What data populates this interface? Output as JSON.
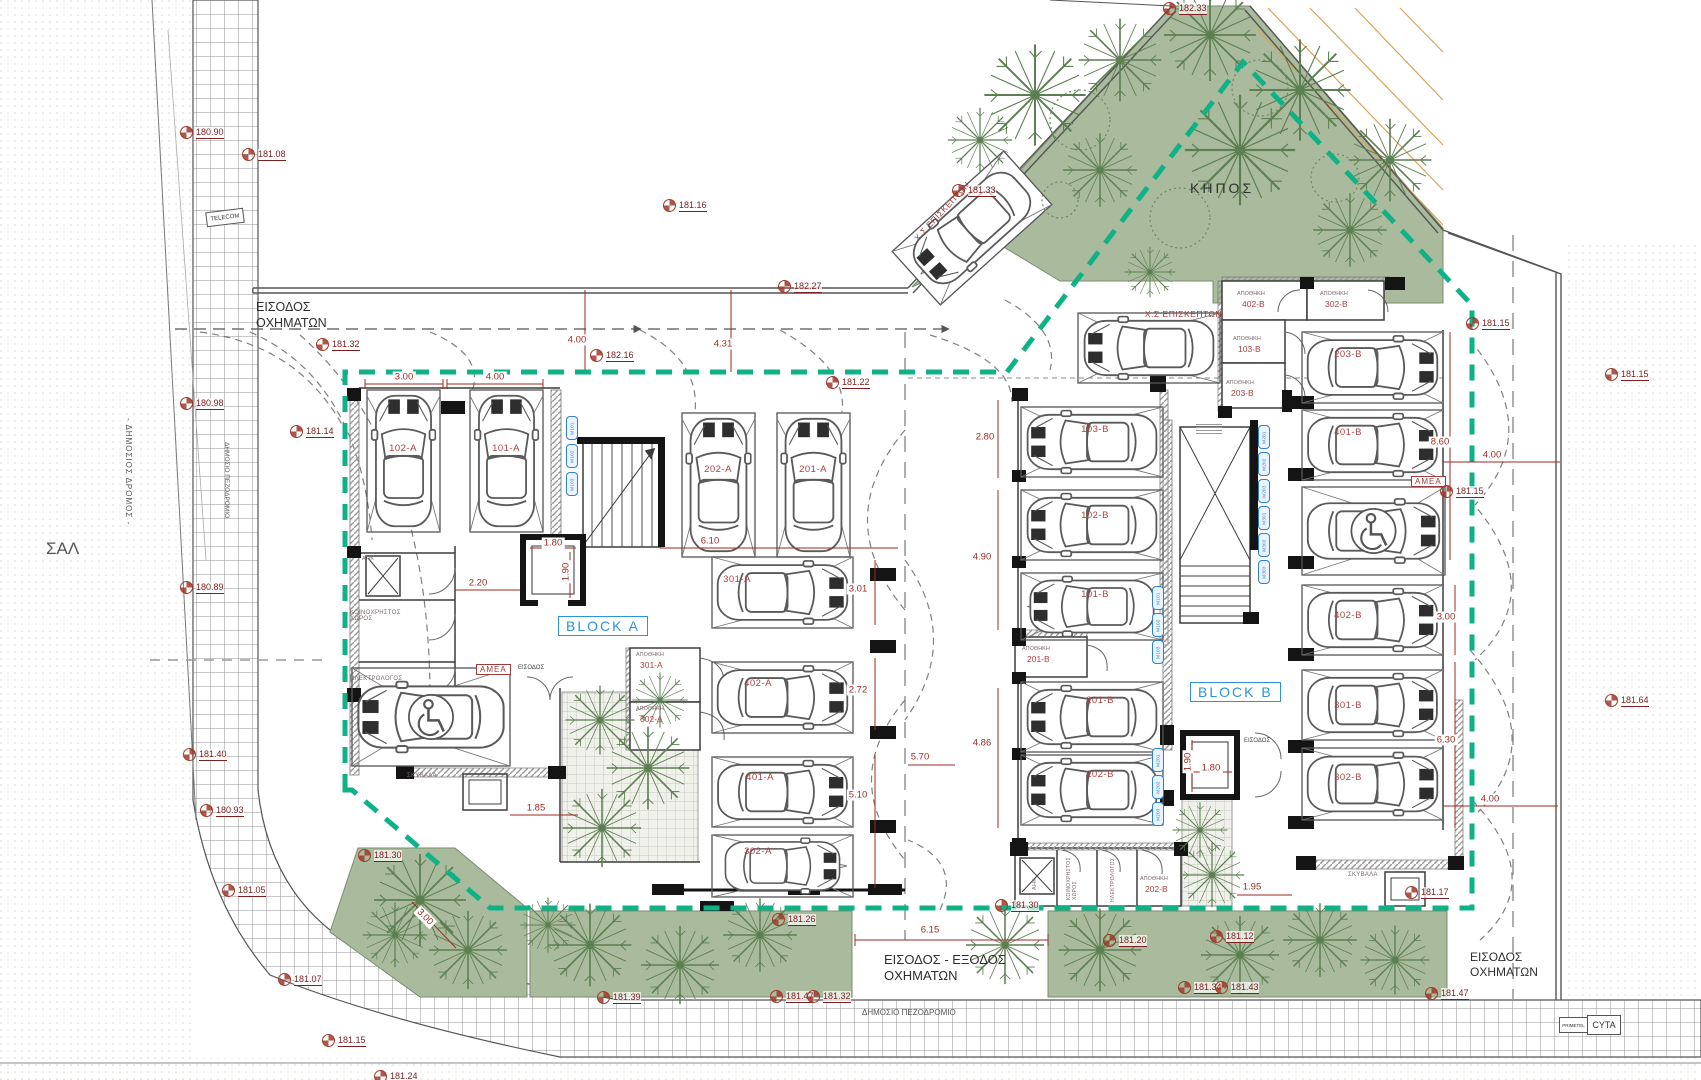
{
  "colors": {
    "boundary_teal": "#0fb286",
    "dim_red": "#9c2b21",
    "parking_red": "#b04040",
    "block_blue": "#2e93d8",
    "green_area": "#a9bb9c",
    "tree_green": "#5c7f52",
    "hatch_orange": "#d9a45b"
  },
  "labels": {
    "garden": "ΚΗΠΟΣ",
    "road_name": "ΣΑΛ",
    "public_road": "- ΔΗΜΟΣΙΟΣ ΔΡΟΜΟΣ -",
    "sidewalk": "ΔΗΜΟΣΙΟ ΠΕΖΟΔΡΟΜΙΟ",
    "entrance_top_l1": "ΕΙΣΟΔΟΣ",
    "entrance_top_l2": "ΟΧΗΜΑΤΩΝ",
    "entrance_exit_l1": "ΕΙΣΟΔΟΣ - ΕΞΟΔΟΣ",
    "entrance_exit_l2": "ΟΧΗΜΑΤΩΝ",
    "entrance_br_l1": "ΕΙΣΟΔΟΣ",
    "entrance_br_l2": "ΟΧΗΜΑΤΩΝ",
    "telecom": "TELECOM",
    "primetel": "PRIMETEL",
    "cyta": "CYTA",
    "block_a": "BLOCK A",
    "block_b": "BLOCK B",
    "entrance_door": "ΕΙΣΟΔΟΣ",
    "visitor": "Χ.Σ ΕΠΙΣΚΕΠΤΩΝ",
    "amea": "ΑΜΕΑ",
    "storage": "ΑΠΟΘΗΚΗ",
    "rooms": {
      "ahk": "ΑΗΚ",
      "common_l1": "ΚΟΙΝΟΧΡΗΣΤΟΣ",
      "common_l2": "ΧΩΡΟΣ",
      "electrician": "ΗΛΕΚΤΡΟΛΟΓΟΣ",
      "garbage": "ΣΚΥΒΑΛΑ"
    }
  },
  "parking": {
    "a": [
      "102-A",
      "101-A",
      "202-A",
      "201-A",
      "301-A",
      "402-A",
      "401-A",
      "302-A"
    ],
    "b_center": [
      "103-B",
      "102-B",
      "101-B",
      "201-B",
      "202-B"
    ],
    "b_right": [
      "203-B",
      "401-B",
      "402-B",
      "301-B",
      "302-B"
    ],
    "storage_a": [
      "301-A",
      "302-A"
    ],
    "storage_b": [
      "402-B",
      "302-B",
      "103-B",
      "203-B",
      "201-B",
      "202-B"
    ],
    "moto_a": [
      "M101",
      "M102",
      "M103"
    ],
    "moto_b_outer": [
      "M201",
      "M202",
      "M203",
      "M301",
      "M302",
      "M303"
    ],
    "moto_b_inner": [
      "M101",
      "M102",
      "M103",
      "M201",
      "M202",
      "M203"
    ]
  },
  "dimensions": {
    "d300_tl": "3.00",
    "d400_tl": "4.00",
    "d400_top": "4.00",
    "d431": "4.31",
    "d610": "6.10",
    "d301": "3.01",
    "d272": "2.72",
    "d510": "5.10",
    "d220": "2.20",
    "d180a": "1.80",
    "d190a": "1.90",
    "d185": "1.85",
    "d280": "2.80",
    "d490": "4.90",
    "d486": "4.86",
    "d570": "5.70",
    "d860": "8.60",
    "d400r1": "4.00",
    "d300r": "3.00",
    "d630": "6.30",
    "d400r2": "4.00",
    "d180b": "1.80",
    "d190b": "1.90",
    "d195": "1.95",
    "d615": "6.15",
    "d300diag": "3.00"
  },
  "elevations": [
    "180.90",
    "181.08",
    "181.16",
    "181.33",
    "182.33",
    "182.27",
    "182.16",
    "181.22",
    "181.32",
    "180.98",
    "181.14",
    "180.89",
    "181.40",
    "180.93",
    "181.05",
    "181.07",
    "181.15",
    "181.24",
    "181.30",
    "181.39",
    "181.47",
    "181.32",
    "181.26",
    "181.30",
    "181.20",
    "181.12",
    "181.34",
    "181.43",
    "181.47",
    "181.17",
    "181.15",
    "181.15",
    "181.15",
    "181.64"
  ]
}
